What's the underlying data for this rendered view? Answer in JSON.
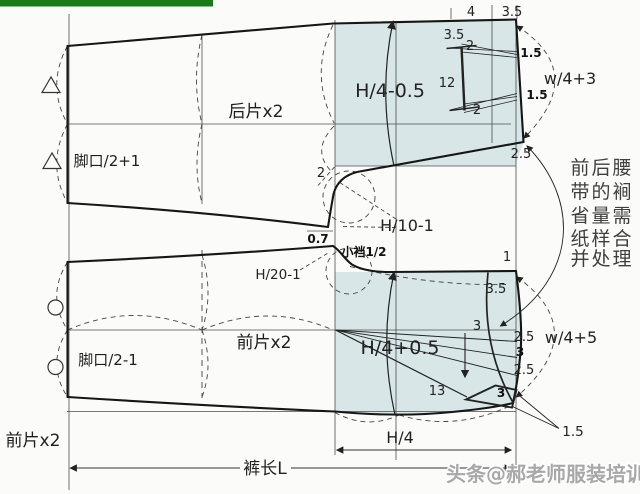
{
  "colors": {
    "green_bar": "#1b7a1b",
    "shade": "#d8e6e8",
    "line": "#1a1a1a"
  },
  "back": {
    "piece_label": "后片x2",
    "hem_formula": "脚口/2+1",
    "width_formula": "H/4-0.5",
    "waist_formula": "w/4+3",
    "crotch_formula": "H/10-1",
    "waist_dim_a": "4",
    "waist_dim_b": "3.5",
    "dart_offset": "3.5",
    "dart_top_width": "2",
    "dart_length": "12",
    "dart_bottom_width": "2",
    "side_take_a": "1.5",
    "side_take_b": "1.5",
    "side_drop": "2.5",
    "corner_dim": "2",
    "crotch_drop": "0.7"
  },
  "front": {
    "piece_label": "前片x2",
    "cut_label": "前片x2",
    "hem_formula": "脚口/2-1",
    "width_formula": "H/4+0.5",
    "waist_formula": "w/4+5",
    "crotch_formula": "H/20-1",
    "small_crotch": "小裆1/2",
    "waist_rise": "1",
    "dart_offset": "3.5",
    "hip_dim": "3",
    "side_seg_a": "2.5",
    "side_seg_b": "3",
    "side_seg_c": "2.5",
    "pocket_length": "13",
    "pocket_width": "3",
    "hem_ease": "1.5"
  },
  "dims": {
    "hip": "H/4",
    "length": "裤长L"
  },
  "note_lines": [
    "前后腰",
    "带的裥",
    "省量需",
    "纸样合",
    "并处理"
  ],
  "watermark": "头条@郝老师服装培训"
}
